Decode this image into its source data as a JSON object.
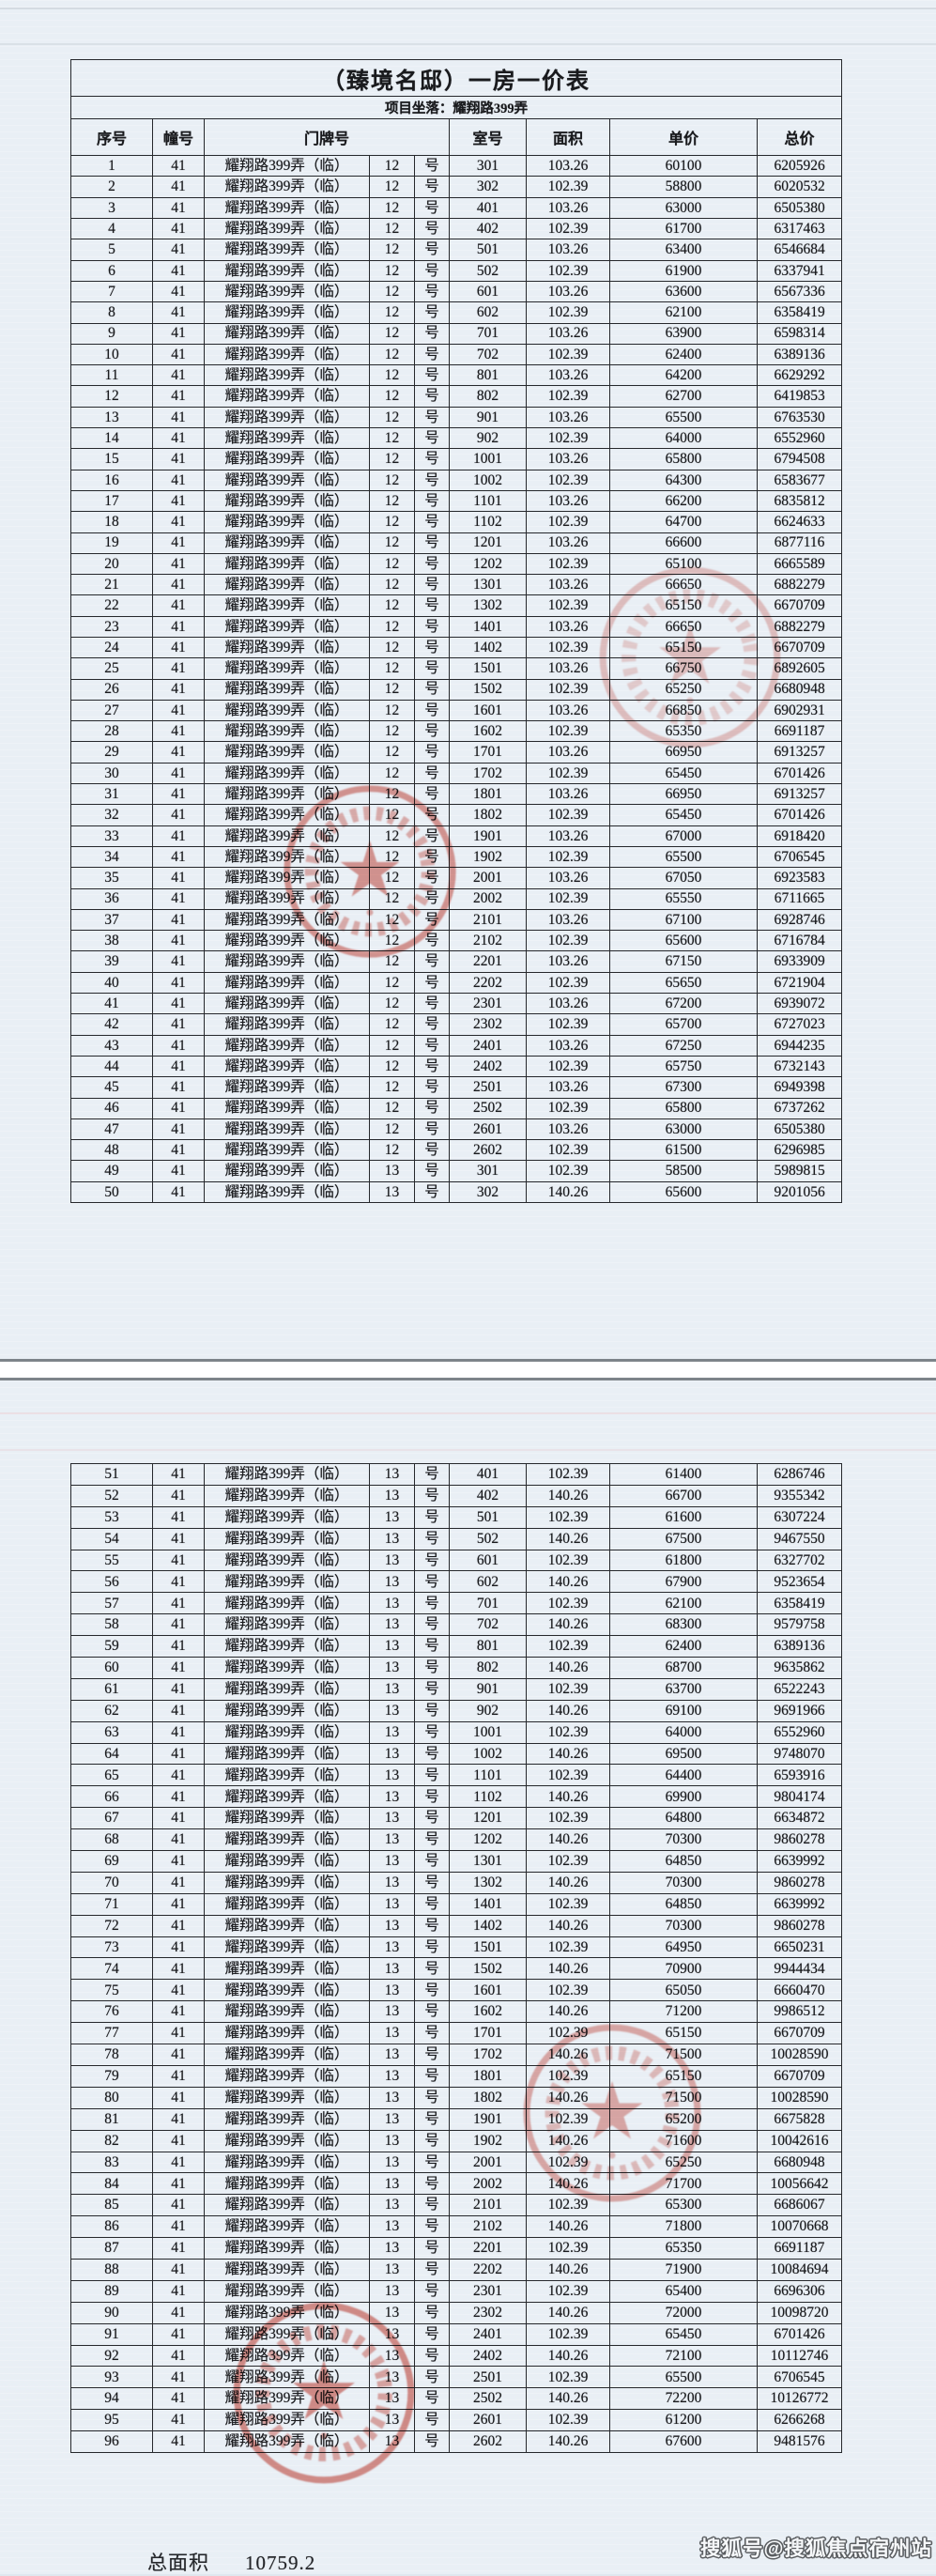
{
  "document": {
    "title": "（臻境名邸）一房一价表",
    "subtitle": "项目坐落：耀翔路399弄",
    "columns": [
      "序号",
      "幢号",
      "门牌号",
      "室号",
      "面积",
      "单价",
      "总价"
    ],
    "building": "41",
    "street": "耀翔路399弄（临）",
    "door_suffix": "号",
    "page1_rows": [
      [
        "1",
        "12",
        "301",
        "103.26",
        "60100",
        "6205926"
      ],
      [
        "2",
        "12",
        "302",
        "102.39",
        "58800",
        "6020532"
      ],
      [
        "3",
        "12",
        "401",
        "103.26",
        "63000",
        "6505380"
      ],
      [
        "4",
        "12",
        "402",
        "102.39",
        "61700",
        "6317463"
      ],
      [
        "5",
        "12",
        "501",
        "103.26",
        "63400",
        "6546684"
      ],
      [
        "6",
        "12",
        "502",
        "102.39",
        "61900",
        "6337941"
      ],
      [
        "7",
        "12",
        "601",
        "103.26",
        "63600",
        "6567336"
      ],
      [
        "8",
        "12",
        "602",
        "102.39",
        "62100",
        "6358419"
      ],
      [
        "9",
        "12",
        "701",
        "103.26",
        "63900",
        "6598314"
      ],
      [
        "10",
        "12",
        "702",
        "102.39",
        "62400",
        "6389136"
      ],
      [
        "11",
        "12",
        "801",
        "103.26",
        "64200",
        "6629292"
      ],
      [
        "12",
        "12",
        "802",
        "102.39",
        "62700",
        "6419853"
      ],
      [
        "13",
        "12",
        "901",
        "103.26",
        "65500",
        "6763530"
      ],
      [
        "14",
        "12",
        "902",
        "102.39",
        "64000",
        "6552960"
      ],
      [
        "15",
        "12",
        "1001",
        "103.26",
        "65800",
        "6794508"
      ],
      [
        "16",
        "12",
        "1002",
        "102.39",
        "64300",
        "6583677"
      ],
      [
        "17",
        "12",
        "1101",
        "103.26",
        "66200",
        "6835812"
      ],
      [
        "18",
        "12",
        "1102",
        "102.39",
        "64700",
        "6624633"
      ],
      [
        "19",
        "12",
        "1201",
        "103.26",
        "66600",
        "6877116"
      ],
      [
        "20",
        "12",
        "1202",
        "102.39",
        "65100",
        "6665589"
      ],
      [
        "21",
        "12",
        "1301",
        "103.26",
        "66650",
        "6882279"
      ],
      [
        "22",
        "12",
        "1302",
        "102.39",
        "65150",
        "6670709"
      ],
      [
        "23",
        "12",
        "1401",
        "103.26",
        "66650",
        "6882279"
      ],
      [
        "24",
        "12",
        "1402",
        "102.39",
        "65150",
        "6670709"
      ],
      [
        "25",
        "12",
        "1501",
        "103.26",
        "66750",
        "6892605"
      ],
      [
        "26",
        "12",
        "1502",
        "102.39",
        "65250",
        "6680948"
      ],
      [
        "27",
        "12",
        "1601",
        "103.26",
        "66850",
        "6902931"
      ],
      [
        "28",
        "12",
        "1602",
        "102.39",
        "65350",
        "6691187"
      ],
      [
        "29",
        "12",
        "1701",
        "103.26",
        "66950",
        "6913257"
      ],
      [
        "30",
        "12",
        "1702",
        "102.39",
        "65450",
        "6701426"
      ],
      [
        "31",
        "12",
        "1801",
        "103.26",
        "66950",
        "6913257"
      ],
      [
        "32",
        "12",
        "1802",
        "102.39",
        "65450",
        "6701426"
      ],
      [
        "33",
        "12",
        "1901",
        "103.26",
        "67000",
        "6918420"
      ],
      [
        "34",
        "12",
        "1902",
        "102.39",
        "65500",
        "6706545"
      ],
      [
        "35",
        "12",
        "2001",
        "103.26",
        "67050",
        "6923583"
      ],
      [
        "36",
        "12",
        "2002",
        "102.39",
        "65550",
        "6711665"
      ],
      [
        "37",
        "12",
        "2101",
        "103.26",
        "67100",
        "6928746"
      ],
      [
        "38",
        "12",
        "2102",
        "102.39",
        "65600",
        "6716784"
      ],
      [
        "39",
        "12",
        "2201",
        "103.26",
        "67150",
        "6933909"
      ],
      [
        "40",
        "12",
        "2202",
        "102.39",
        "65650",
        "6721904"
      ],
      [
        "41",
        "12",
        "2301",
        "103.26",
        "67200",
        "6939072"
      ],
      [
        "42",
        "12",
        "2302",
        "102.39",
        "65700",
        "6727023"
      ],
      [
        "43",
        "12",
        "2401",
        "103.26",
        "67250",
        "6944235"
      ],
      [
        "44",
        "12",
        "2402",
        "102.39",
        "65750",
        "6732143"
      ],
      [
        "45",
        "12",
        "2501",
        "103.26",
        "67300",
        "6949398"
      ],
      [
        "46",
        "12",
        "2502",
        "102.39",
        "65800",
        "6737262"
      ],
      [
        "47",
        "12",
        "2601",
        "103.26",
        "63000",
        "6505380"
      ],
      [
        "48",
        "12",
        "2602",
        "102.39",
        "61500",
        "6296985"
      ],
      [
        "49",
        "13",
        "301",
        "102.39",
        "58500",
        "5989815"
      ],
      [
        "50",
        "13",
        "302",
        "140.26",
        "65600",
        "9201056"
      ]
    ],
    "page2_rows": [
      [
        "51",
        "13",
        "401",
        "102.39",
        "61400",
        "6286746"
      ],
      [
        "52",
        "13",
        "402",
        "140.26",
        "66700",
        "9355342"
      ],
      [
        "53",
        "13",
        "501",
        "102.39",
        "61600",
        "6307224"
      ],
      [
        "54",
        "13",
        "502",
        "140.26",
        "67500",
        "9467550"
      ],
      [
        "55",
        "13",
        "601",
        "102.39",
        "61800",
        "6327702"
      ],
      [
        "56",
        "13",
        "602",
        "140.26",
        "67900",
        "9523654"
      ],
      [
        "57",
        "13",
        "701",
        "102.39",
        "62100",
        "6358419"
      ],
      [
        "58",
        "13",
        "702",
        "140.26",
        "68300",
        "9579758"
      ],
      [
        "59",
        "13",
        "801",
        "102.39",
        "62400",
        "6389136"
      ],
      [
        "60",
        "13",
        "802",
        "140.26",
        "68700",
        "9635862"
      ],
      [
        "61",
        "13",
        "901",
        "102.39",
        "63700",
        "6522243"
      ],
      [
        "62",
        "13",
        "902",
        "140.26",
        "69100",
        "9691966"
      ],
      [
        "63",
        "13",
        "1001",
        "102.39",
        "64000",
        "6552960"
      ],
      [
        "64",
        "13",
        "1002",
        "140.26",
        "69500",
        "9748070"
      ],
      [
        "65",
        "13",
        "1101",
        "102.39",
        "64400",
        "6593916"
      ],
      [
        "66",
        "13",
        "1102",
        "140.26",
        "69900",
        "9804174"
      ],
      [
        "67",
        "13",
        "1201",
        "102.39",
        "64800",
        "6634872"
      ],
      [
        "68",
        "13",
        "1202",
        "140.26",
        "70300",
        "9860278"
      ],
      [
        "69",
        "13",
        "1301",
        "102.39",
        "64850",
        "6639992"
      ],
      [
        "70",
        "13",
        "1302",
        "140.26",
        "70300",
        "9860278"
      ],
      [
        "71",
        "13",
        "1401",
        "102.39",
        "64850",
        "6639992"
      ],
      [
        "72",
        "13",
        "1402",
        "140.26",
        "70300",
        "9860278"
      ],
      [
        "73",
        "13",
        "1501",
        "102.39",
        "64950",
        "6650231"
      ],
      [
        "74",
        "13",
        "1502",
        "140.26",
        "70900",
        "9944434"
      ],
      [
        "75",
        "13",
        "1601",
        "102.39",
        "65050",
        "6660470"
      ],
      [
        "76",
        "13",
        "1602",
        "140.26",
        "71200",
        "9986512"
      ],
      [
        "77",
        "13",
        "1701",
        "102.39",
        "65150",
        "6670709"
      ],
      [
        "78",
        "13",
        "1702",
        "140.26",
        "71500",
        "10028590"
      ],
      [
        "79",
        "13",
        "1801",
        "102.39",
        "65150",
        "6670709"
      ],
      [
        "80",
        "13",
        "1802",
        "140.26",
        "71500",
        "10028590"
      ],
      [
        "81",
        "13",
        "1901",
        "102.39",
        "65200",
        "6675828"
      ],
      [
        "82",
        "13",
        "1902",
        "140.26",
        "71600",
        "10042616"
      ],
      [
        "83",
        "13",
        "2001",
        "102.39",
        "65250",
        "6680948"
      ],
      [
        "84",
        "13",
        "2002",
        "140.26",
        "71700",
        "10056642"
      ],
      [
        "85",
        "13",
        "2101",
        "102.39",
        "65300",
        "6686067"
      ],
      [
        "86",
        "13",
        "2102",
        "140.26",
        "71800",
        "10070668"
      ],
      [
        "87",
        "13",
        "2201",
        "102.39",
        "65350",
        "6691187"
      ],
      [
        "88",
        "13",
        "2202",
        "140.26",
        "71900",
        "10084694"
      ],
      [
        "89",
        "13",
        "2301",
        "102.39",
        "65400",
        "6696306"
      ],
      [
        "90",
        "13",
        "2302",
        "140.26",
        "72000",
        "10098720"
      ],
      [
        "91",
        "13",
        "2401",
        "102.39",
        "65450",
        "6701426"
      ],
      [
        "92",
        "13",
        "2402",
        "140.26",
        "72100",
        "10112746"
      ],
      [
        "93",
        "13",
        "2501",
        "102.39",
        "65500",
        "6706545"
      ],
      [
        "94",
        "13",
        "2502",
        "140.26",
        "72200",
        "10126772"
      ],
      [
        "95",
        "13",
        "2601",
        "102.39",
        "61200",
        "6266268"
      ],
      [
        "96",
        "13",
        "2602",
        "140.26",
        "67600",
        "9481576"
      ]
    ],
    "footer": {
      "total_area_label": "总面积",
      "total_area_value": "10759.2"
    }
  },
  "watermark": "搜狐号@搜狐焦点宿州站",
  "colors": {
    "seal_red": "#c8372a",
    "page_tint": "#e9eff5"
  }
}
